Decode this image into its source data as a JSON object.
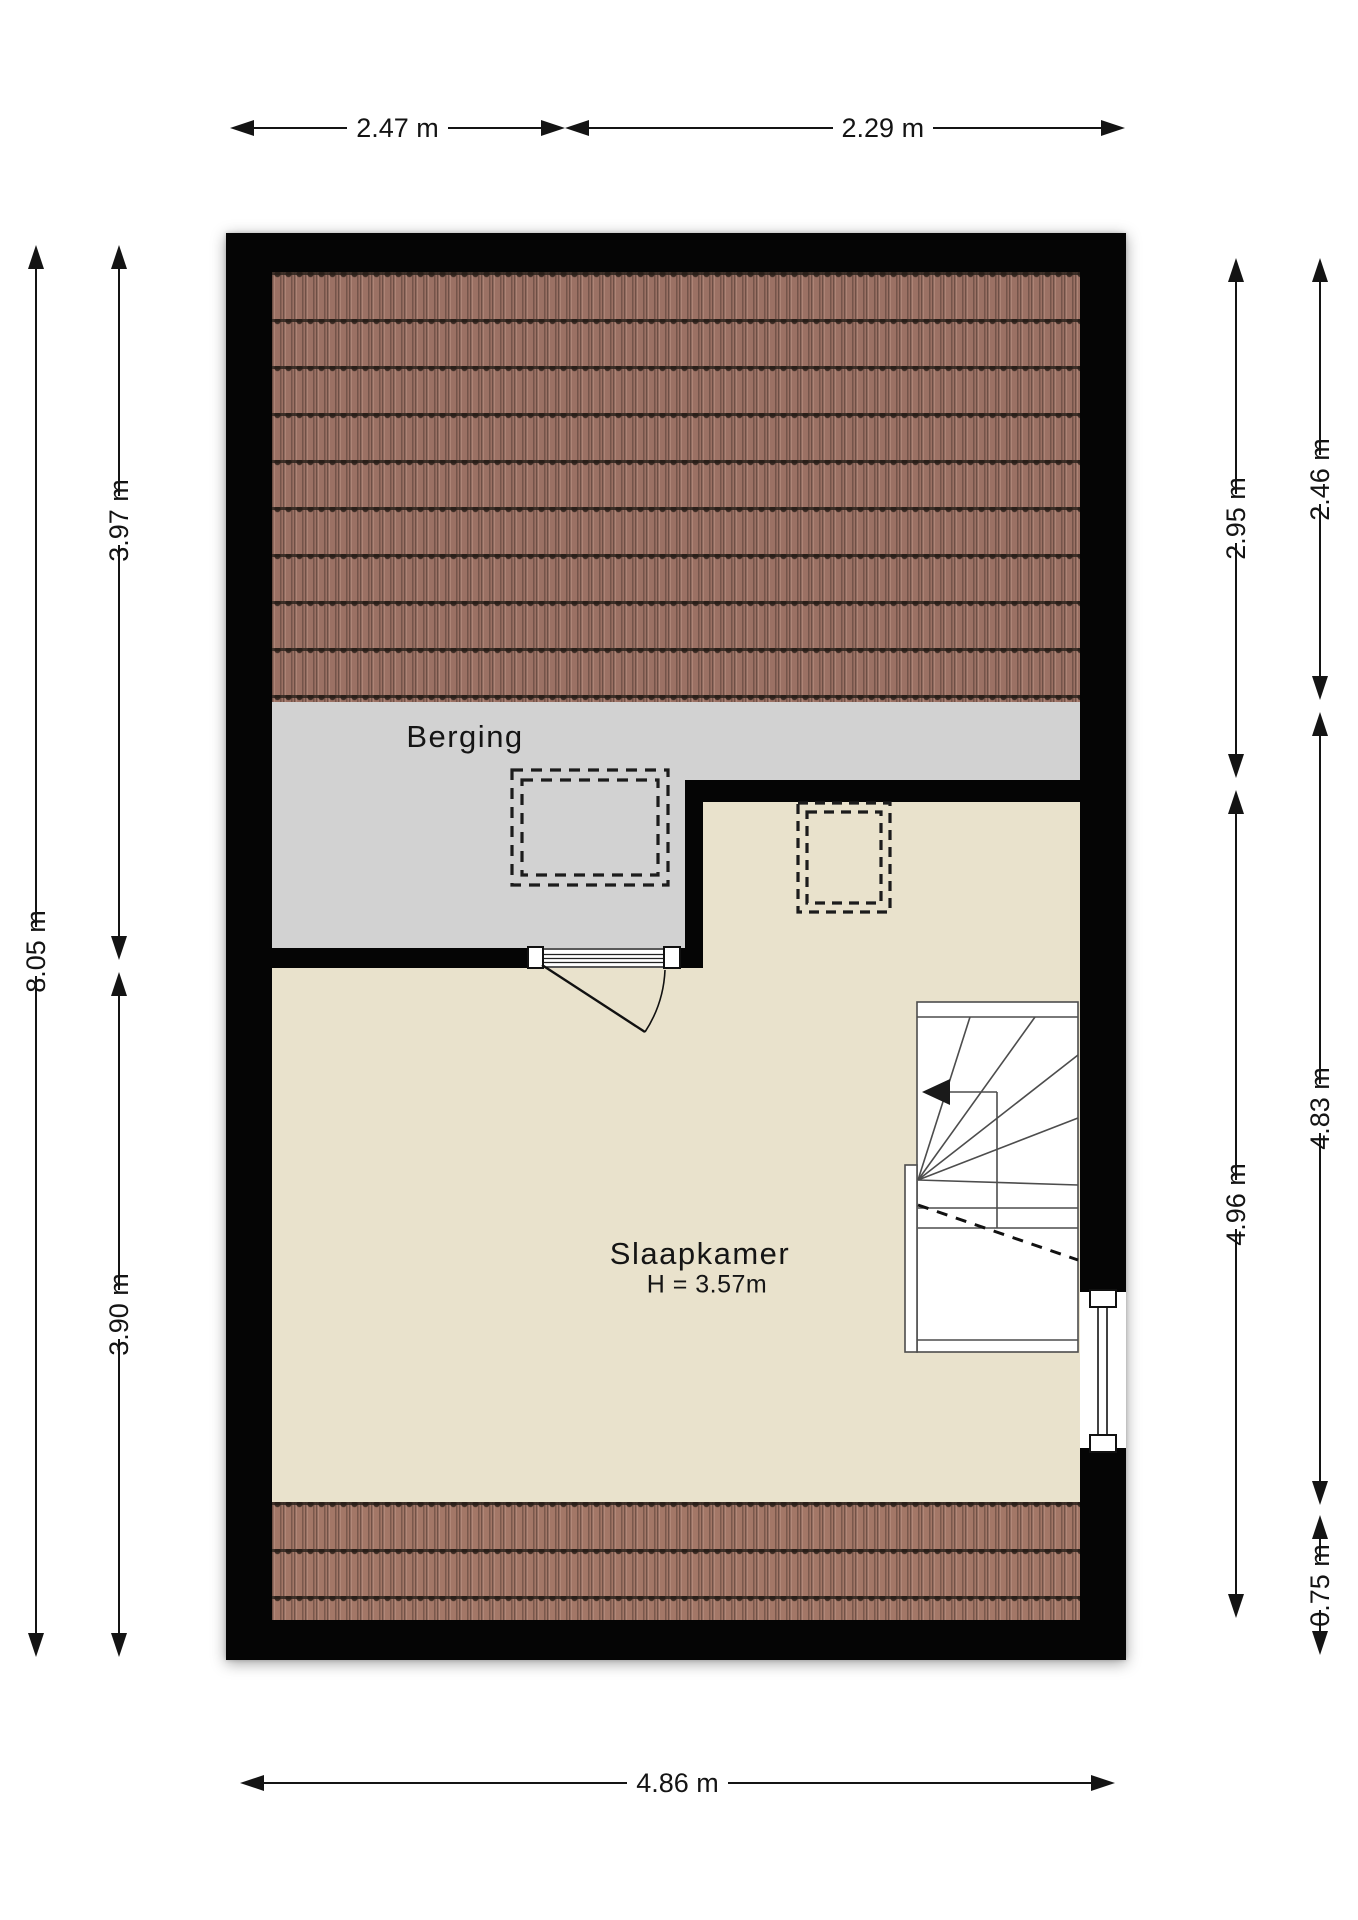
{
  "plan_type": "floor-plan",
  "rooms": {
    "storage": {
      "label": "Berging"
    },
    "bedroom": {
      "label": "Slaapkamer",
      "ceiling": "H = 3.57m"
    }
  },
  "dimensions": {
    "top_left": "2.47 m",
    "top_right": "2.29 m",
    "bottom": "4.86 m",
    "left_total": "8.05 m",
    "left_upper": "3.97 m",
    "left_lower": "3.90 m",
    "right_inner_upper": "2.95 m",
    "right_inner_lower": "4.96 m",
    "right_outer_upper": "2.46 m",
    "right_outer_middle": "4.83 m",
    "right_outer_lower": "0.75 m"
  },
  "icons": {
    "stair_direction_arrow": "left-pointing solid triangle",
    "dimension_arrows": "solid triangle arrowheads",
    "door_swing": "quarter-circle arc",
    "skylights": "double dashed rectangles"
  },
  "colors": {
    "wall": "#050505",
    "roof_tiles_top": "#9b7164",
    "roof_tiles_bottom": "#a37767",
    "storage_floor": "#d2d2d2",
    "bedroom_floor": "#e9e2cc",
    "dimension_ink": "#141414"
  }
}
